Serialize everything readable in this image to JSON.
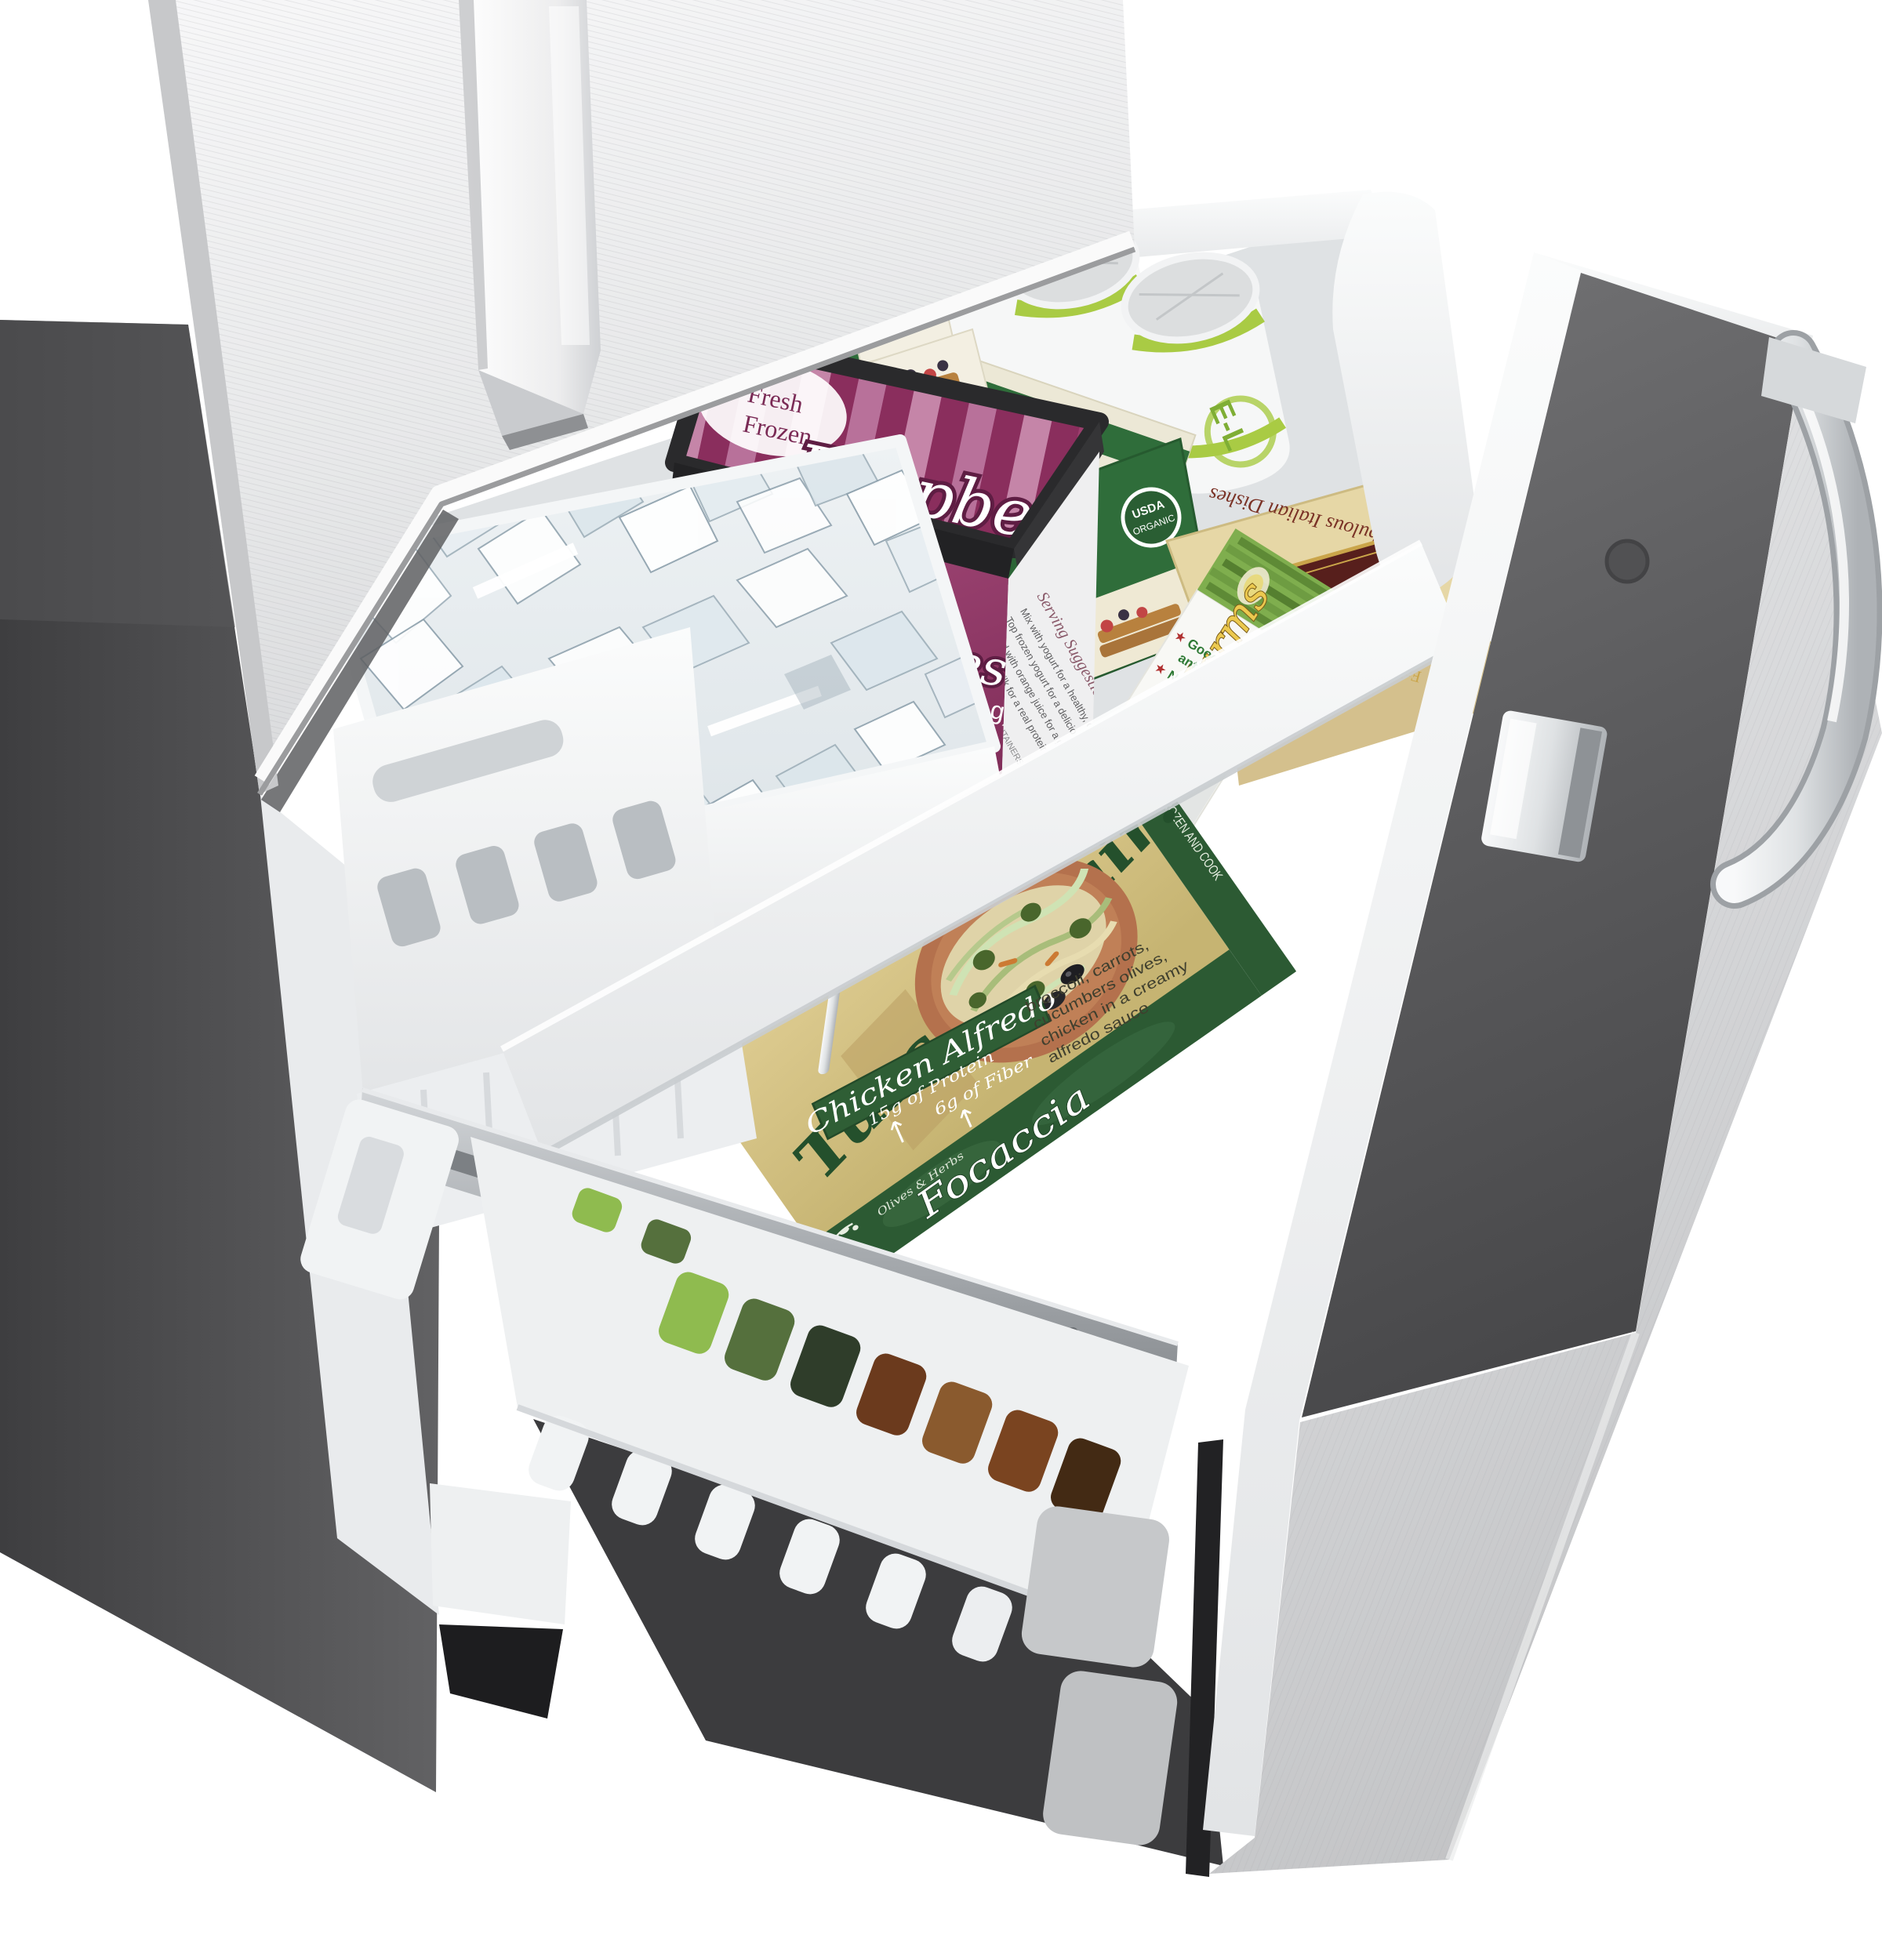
{
  "colors": {
    "background": "#ffffff",
    "cabinet_gray": "#4e4e50",
    "stainless_light": "#eceded",
    "stainless_mid": "#d2d3d5",
    "drawer_liner_gray": "#5c5c5e",
    "plastic_white": "#f4f5f6",
    "tin_magenta_dark": "#8a2e5d",
    "tin_magenta_light": "#b8719a",
    "tin_rim_black": "#2a2a2c",
    "waffle_green": "#2f6d3a",
    "waffle_cream": "#ece8d6",
    "can_green": "#9fc43e",
    "italian_tan": "#e6d7a6",
    "italian_maroon": "#571f1c",
    "matus_yellow": "#e7c44a",
    "tuscan_parchment": "#d6c487",
    "tuscan_green": "#2c5a33",
    "chrome": "#e8eaec"
  },
  "packages": {
    "raspberry_tin": {
      "brand_top": "Fresh",
      "brand_bottom": "Frozen",
      "product": "Raspberries",
      "weight": "10 oz. (283 g)",
      "side_heading": "Serving Suggestions",
      "suggestions": [
        "Mix with yogurt for a healthy, colorful breakfast",
        "Top frozen yogurt for a delicious dessert",
        "Blend with orange juice for a great smoothie",
        "Top with milk for a real protein treat"
      ],
      "side_note": "PACKAGED IN ALL CONTAINERS WITH ORGANIC STANDARDS"
    },
    "waffle_boxes": {
      "product": "multi-grain waffles",
      "seal_line1": "USDA",
      "seal_line2": "ORGANIC"
    },
    "juice_can": {
      "label_fragment": "E-L"
    },
    "italian_box": {
      "brand": "Pepe G's",
      "title": "Fabulous Italian Dishes",
      "subtitle": "Crab Crostini"
    },
    "matus_box": {
      "brand": "Matus Farms",
      "since": "Since 1968",
      "star": "★",
      "bullet_vitamin_1": "Good source of the",
      "bullet_vitamin_2": "antioxidant Vitamin C",
      "bullet_colors": "No artificial colors"
    },
    "tuscan_meal": {
      "headline": "Tuscan Flair!",
      "variety": "Chicken Alfredo",
      "protein": "15g of Protein",
      "fiber": "6g of Fiber",
      "desc_line1": "broccoli, carrots,",
      "desc_line2": "cucumbers olives,",
      "desc_line3": "chicken in a creamy",
      "desc_line4": "alfredo sauce",
      "keep_frozen": "KEEP FROZEN AND COOK",
      "focaccia": "Focaccia",
      "focaccia_sub": "Olives & Herbs"
    },
    "focaccia_box": {
      "fragment_line1": "Olive & Cheese",
      "fragment_line2": "Focaccia"
    }
  }
}
